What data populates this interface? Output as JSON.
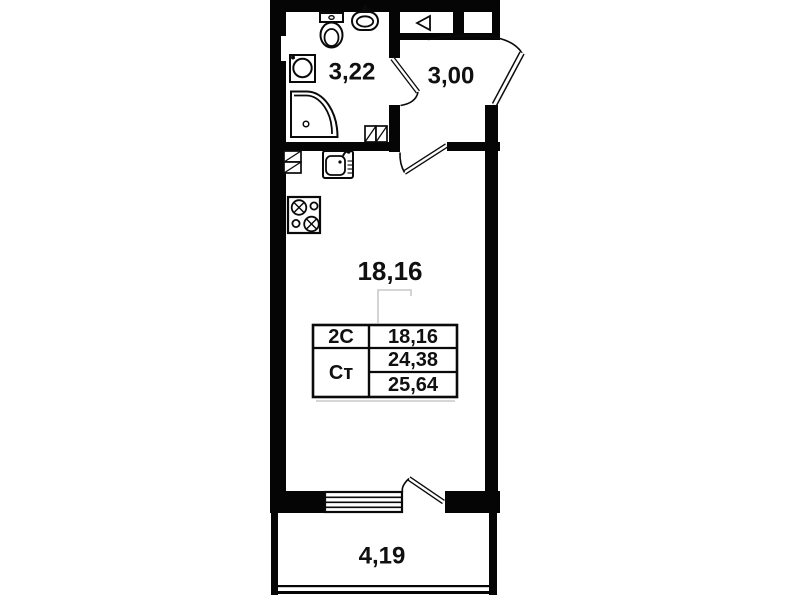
{
  "plan": {
    "bathroom_area": "3,22",
    "hall_area": "3,00",
    "living_area": "18,16",
    "balcony_area": "4,19"
  },
  "info_table": {
    "rows": [
      {
        "label": "2С",
        "values": [
          "18,16"
        ]
      },
      {
        "label": "Ст",
        "values": [
          "24,38",
          "25,64"
        ]
      }
    ]
  },
  "colors": {
    "wall": "#050505",
    "background": "#ffffff",
    "ghost_line": "#c9c9c9"
  }
}
